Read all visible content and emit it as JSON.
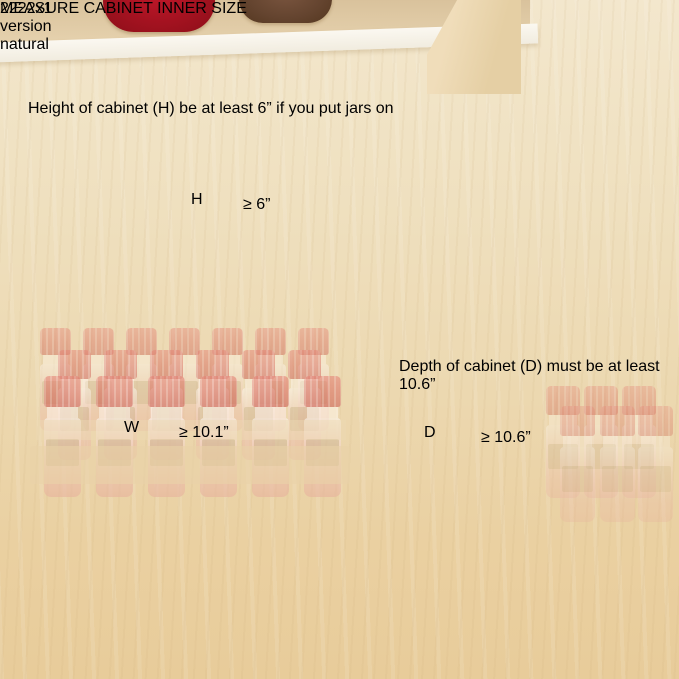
{
  "badge": {
    "line1": "2222x1",
    "line2": "version",
    "line3": "natural"
  },
  "height_note": {
    "line1": "Height of cabinet (H) be",
    "line2": "at least 6” if you put",
    "line3": "jars on"
  },
  "depth_note": {
    "line1": "Depth of cabinet (D)",
    "line2": "must be at least 10.6”"
  },
  "measurements": {
    "height": {
      "label": "H",
      "value": "≥ 6”"
    },
    "width": {
      "label": "W",
      "value": "≥ 10.1”"
    },
    "depth": {
      "label": "D",
      "value": "≥ 10.6”"
    }
  },
  "banner": {
    "highlight": "MEASURE",
    "rest": " CABINET INNER SIZE"
  },
  "colors": {
    "accent_red": "#e3201b",
    "accent_orange": "#f6a21d",
    "badge_bg": "#5b5853",
    "banner_bg": "#53514f",
    "note_text": "#5f5d5a"
  }
}
